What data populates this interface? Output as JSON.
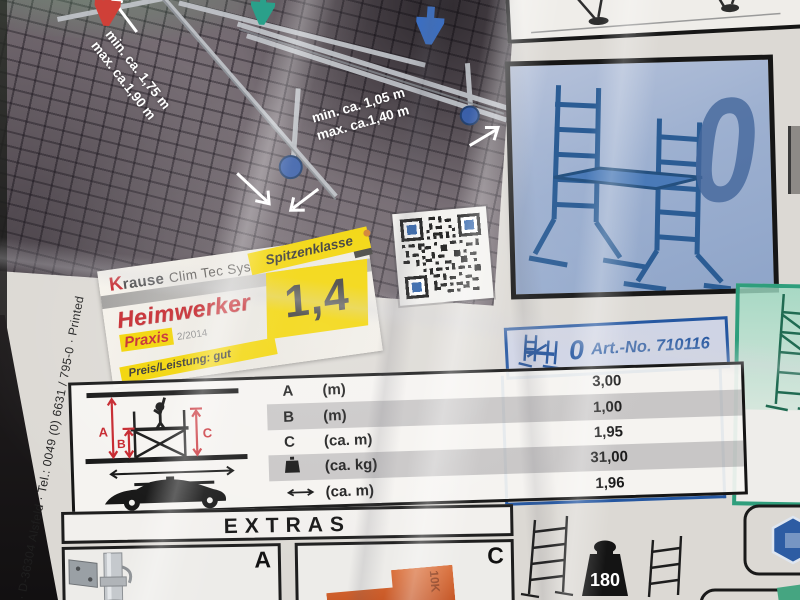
{
  "measurements": {
    "left": {
      "line1": "min. ca. 1,75 m",
      "line2": "max. ca.1,90 m"
    },
    "right": {
      "line1": "min. ca. 1,05 m",
      "line2": "max. ca.1,40 m"
    }
  },
  "award_label": {
    "brand_initial": "K",
    "brand_rest": "rause",
    "brand_system": "Clim Tec System",
    "tier_badge": "Spitzenklasse",
    "score": "1,4",
    "magazine_name": "Heimwerker",
    "magazine_sub": "Praxis",
    "issue": "2/2014",
    "verdict": "Preis/Leistung: gut"
  },
  "size_panel": {
    "size_digit": "0"
  },
  "article_box": {
    "size_digit": "0",
    "art_no": "Art.-No. 710116"
  },
  "spec_table": {
    "diagram_labels": {
      "a": "A",
      "b": "B",
      "c": "C"
    },
    "rows": [
      {
        "key": "A",
        "unit": "(m)",
        "value": "3,00"
      },
      {
        "key": "B",
        "unit": "(m)",
        "value": "1,00"
      },
      {
        "key": "C",
        "unit": "(ca. m)",
        "value": "1,95"
      },
      {
        "key": "",
        "unit": "(ca. kg)",
        "value": "31,00"
      },
      {
        "key": "",
        "unit": "(ca. m)",
        "value": "1,96"
      }
    ]
  },
  "extras_section": {
    "title": "EXTRAS",
    "panel_a_label": "A",
    "panel_c_label": "C",
    "orange_part_text": "10K"
  },
  "capacity_badge": {
    "value": "180"
  },
  "edge_text": "· D-36304 Alsfeld · Tel.: 0049 (0) 6631 / 795-0 · Printed",
  "colors": {
    "accent_yellow": "#f2d400",
    "brand_red": "#c5252b",
    "panel_blue": "#2456a0",
    "panel_green": "#2f9e7c",
    "qr_finder_blue": "#2a5fa8"
  }
}
